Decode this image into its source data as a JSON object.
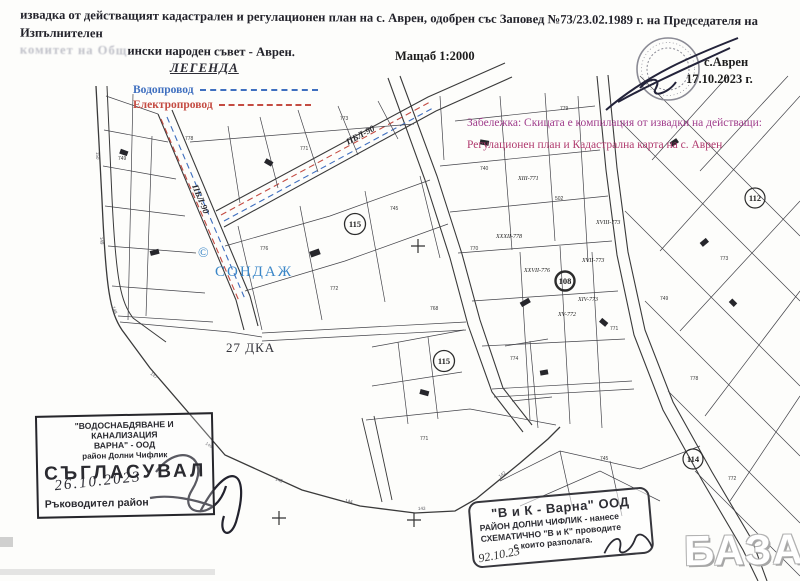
{
  "header": {
    "title_line1": "извадка от действащият кадастрален и регулационен план на с. Аврен, одобрен със Заповед №73/23.02.1989 г. на Председателя на Изпълнителен",
    "title_line2_faded": "комитет на Общ",
    "title_line2": "ински народен съвет - Аврен.",
    "scale_label": "Мащаб 1:2000",
    "place": "с.Аврен",
    "date": "17.10.2023 г."
  },
  "legend": {
    "title": "ЛЕГЕНДА",
    "water_label": "Водопровод",
    "power_label": "Електропровод",
    "water_color": "#3f6fbf",
    "power_color": "#c44b42"
  },
  "note": {
    "line1": "Забележка: Скицата е компилация от извадки на действащи:",
    "line2": "Регулационен план и Кадастрална карта на с. Аврен",
    "color_line1": "#a03e8c",
    "color_line2": "#b03a6e"
  },
  "map": {
    "copyright": "©",
    "sondazh": "СОНДАЖ",
    "area_label": "27 ДКА",
    "street1": "ПБЛ-90",
    "street2": "ПБЛ-90",
    "circles": [
      {
        "num": "115"
      },
      {
        "num": "115"
      },
      {
        "num": "108"
      },
      {
        "num": "112"
      },
      {
        "num": "114"
      }
    ],
    "parcel_labels": [
      "XXVII-776",
      "XVII-773",
      "XIV-773",
      "XV-772",
      "XXXII-778",
      "XIII-771",
      "XVIII-773"
    ],
    "small_numbers": [
      "749",
      "778",
      "771",
      "773",
      "776",
      "745",
      "772",
      "740",
      "502",
      "770",
      "768",
      "774",
      "771",
      "749",
      "773",
      "778",
      "772",
      "745",
      "771",
      "779"
    ],
    "boundary_ticks": [
      "150",
      "149",
      "148",
      "147",
      "146",
      "145",
      "144",
      "143",
      "142"
    ]
  },
  "stamp_approval": {
    "org_line1": "\"ВОДОСНАБДЯВАНЕ И КАНАЛИЗАЦИЯ",
    "org_line2": "ВАРНА\" - ООД",
    "org_line3": "район Долни Чифлик",
    "approved": "СЪГЛАСУВАЛ",
    "handwritten_date": "26.10.2023",
    "signer": "Ръководител район"
  },
  "stamp_vik": {
    "line1": "\"В и К - Варна\" ООД",
    "line2": "РАЙОН ДОЛНИ ЧИФЛИК - нанесе",
    "line3": "СХЕМАТИЧНО \"В и К\" проводите",
    "line4": "с които разполага.",
    "handwritten_date": "92.10.23"
  },
  "watermark": "БАЗАР"
}
